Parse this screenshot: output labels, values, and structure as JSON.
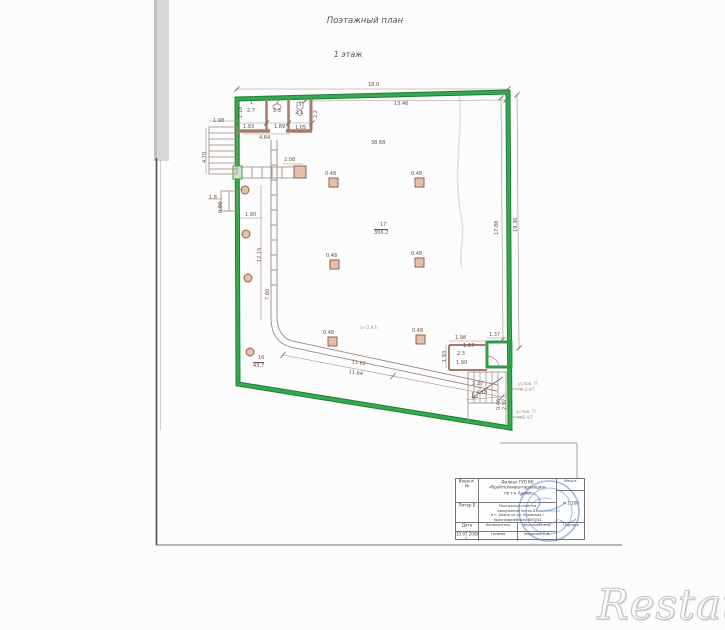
{
  "titles": {
    "main": "Поэтажный план",
    "floor": "1 этаж"
  },
  "watermark": "Restate",
  "colors": {
    "boundary_green": "#2e9c46",
    "wall_brown": "#a87a67",
    "column_fill": "#e2c0ae",
    "drawing_line": "#9a8a82",
    "stamp_blue": "#4d70be",
    "dim_text": "#6d5146"
  },
  "plan": {
    "labels": [
      {
        "t": "18.0",
        "x": 368,
        "y": 83
      },
      {
        "t": "13.46",
        "x": 394,
        "y": 102
      },
      {
        "t": "38.68",
        "x": 371,
        "y": 141
      },
      {
        "t": "0.48",
        "x": 325,
        "y": 172
      },
      {
        "t": "0.48",
        "x": 411,
        "y": 172
      },
      {
        "t": "0.48",
        "x": 326,
        "y": 254
      },
      {
        "t": "0.48",
        "x": 411,
        "y": 252
      },
      {
        "t": "0.48",
        "x": 323,
        "y": 331
      },
      {
        "t": "0.48",
        "x": 412,
        "y": 329
      },
      {
        "t": "17",
        "x": 380,
        "y": 223
      },
      {
        "t": "306.2",
        "x": 374,
        "y": 229,
        "ul": true
      },
      {
        "t": "16",
        "x": 258,
        "y": 356
      },
      {
        "t": "43.7",
        "x": 253,
        "y": 362,
        "ul": true
      },
      {
        "t": "(н-2.97)",
        "x": 360,
        "y": 327,
        "faint": true
      },
      {
        "t": "11.62",
        "x": 352,
        "y": 360,
        "r": 9
      },
      {
        "t": "11.64",
        "x": 349,
        "y": 370,
        "r": 9
      },
      {
        "t": "17.88",
        "x": 495,
        "y": 235,
        "r": -90
      },
      {
        "t": "19.36",
        "x": 514,
        "y": 232,
        "r": -90
      },
      {
        "t": "1",
        "x": 250,
        "y": 101
      },
      {
        "t": "2.7",
        "x": 247,
        "y": 109
      },
      {
        "t": "2",
        "x": 276,
        "y": 101
      },
      {
        "t": "2.3",
        "x": 273,
        "y": 109
      },
      {
        "t": "3",
        "x": 298,
        "y": 103
      },
      {
        "t": "2.1",
        "x": 295,
        "y": 111
      },
      {
        "t": "2.18",
        "x": 239,
        "y": 118,
        "r": -90
      },
      {
        "t": "2.2",
        "x": 314,
        "y": 118,
        "r": -90
      },
      {
        "t": "1.93",
        "x": 243,
        "y": 125
      },
      {
        "t": "1.89",
        "x": 274,
        "y": 125
      },
      {
        "t": "1.05",
        "x": 295,
        "y": 126
      },
      {
        "t": "4.64",
        "x": 259,
        "y": 136
      },
      {
        "t": "1.98",
        "x": 213,
        "y": 119
      },
      {
        "t": "4.70",
        "x": 203,
        "y": 163,
        "r": -90
      },
      {
        "t": "1.8",
        "x": 209,
        "y": 196
      },
      {
        "t": "0.90",
        "x": 219,
        "y": 213,
        "r": -90
      },
      {
        "t": "1.90",
        "x": 245,
        "y": 213
      },
      {
        "t": "2.08",
        "x": 284,
        "y": 158
      },
      {
        "t": "12.15",
        "x": 258,
        "y": 262,
        "r": -90
      },
      {
        "t": "7.80",
        "x": 266,
        "y": 300,
        "r": -90
      },
      {
        "t": "1.98",
        "x": 455,
        "y": 336
      },
      {
        "t": "1.37",
        "x": 489,
        "y": 333
      },
      {
        "t": "1.97",
        "x": 463,
        "y": 344
      },
      {
        "t": "1.93",
        "x": 443,
        "y": 362,
        "r": -90
      },
      {
        "t": "2.3",
        "x": 457,
        "y": 352
      },
      {
        "t": "1.90",
        "x": 456,
        "y": 361
      },
      {
        "t": "2.27",
        "x": 472,
        "y": 382
      },
      {
        "t": "4.18",
        "x": 476,
        "y": 391
      },
      {
        "t": "0.46",
        "x": 497,
        "y": 410,
        "r": -90
      },
      {
        "t": "2.97",
        "x": 503,
        "y": 410,
        "r": -90
      },
      {
        "t": "услов. П",
        "x": 518,
        "y": 383,
        "faint": true
      },
      {
        "t": "н-2.97",
        "x": 520,
        "y": 389,
        "faint": true
      },
      {
        "t": "услов. П",
        "x": 516,
        "y": 411,
        "faint": true
      },
      {
        "t": "н-2.97",
        "x": 518,
        "y": 417,
        "faint": true
      }
    ]
  },
  "title_block": {
    "left_col": {
      "r1": "Инвент. №",
      "r2": "Литер Б",
      "r3": "Дата",
      "r4": "15.07.2008 г."
    },
    "org_lines": [
      "Филиал ГУП КК",
      "«Крайтехинвентаризация»",
      "по г-к Анапа"
    ],
    "doc_lines": [
      "Поэтажный план на",
      "сооружение литер Б1",
      "в г. Анапа по ул. Крымская /",
      "Красноармейская №53/41"
    ],
    "scale_label": "Масшт.",
    "scale_value": "м 1:100",
    "role1": "Исполнитель",
    "role2": "Начальник отд.",
    "name1": "Гасиева",
    "name2": "Зырянова О.В.",
    "sign_label": "Подпись"
  }
}
